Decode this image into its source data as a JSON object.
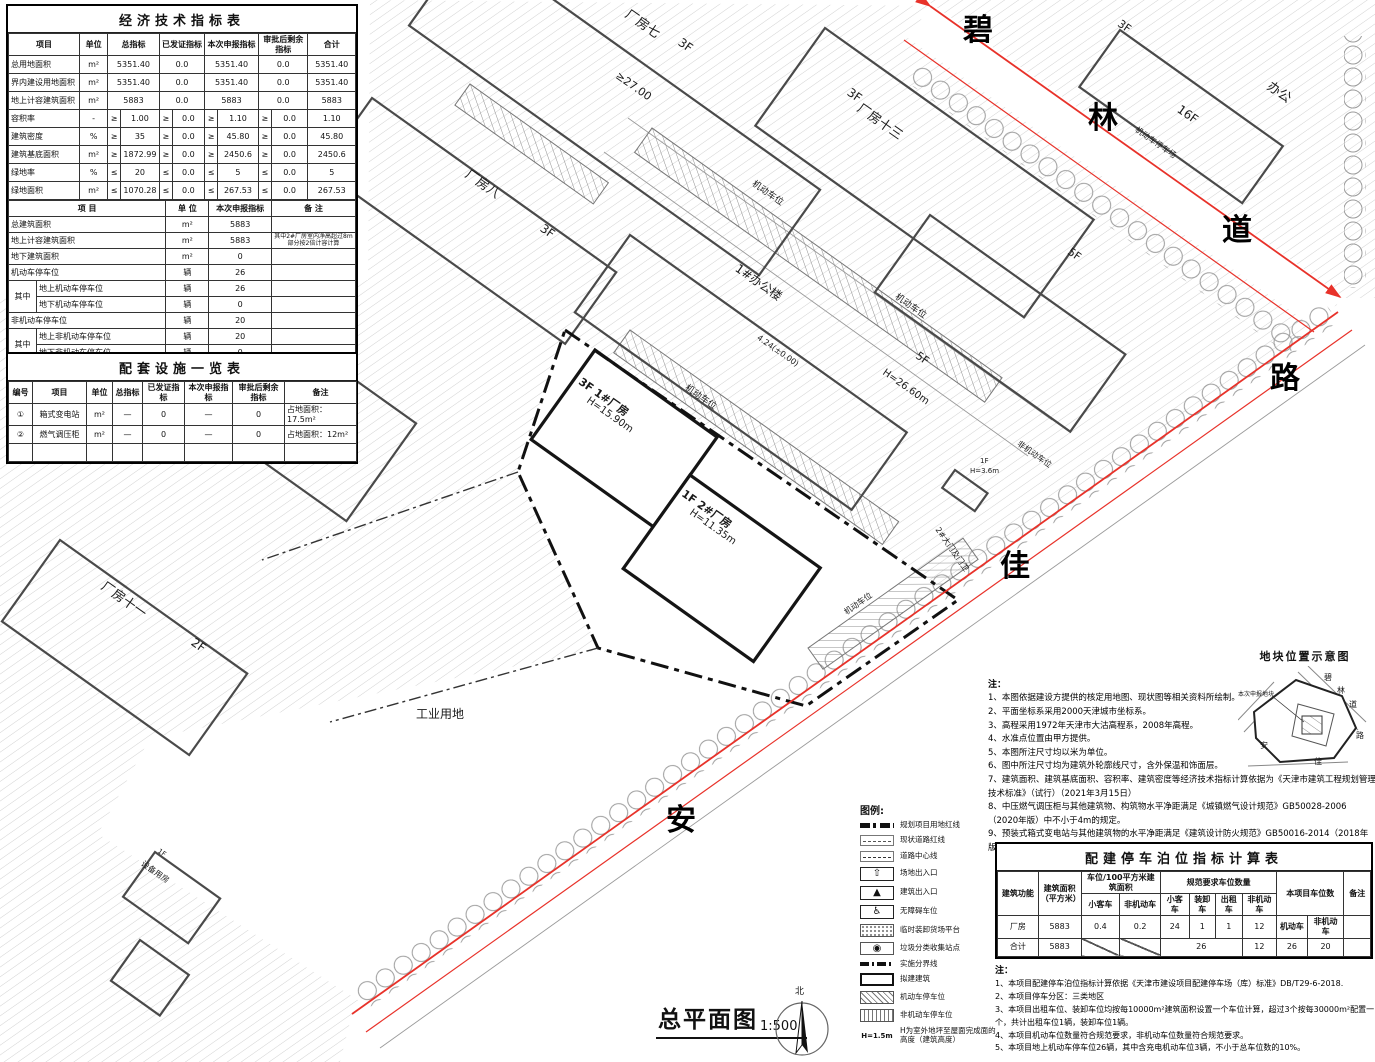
{
  "sheet": {
    "title": "总平面图",
    "scale": "1:500",
    "north_label": "北"
  },
  "econ_table": {
    "title": "经济技术指标表",
    "rows": [
      [
        {
          "t": "项目",
          "h": 1
        },
        {
          "t": "单位",
          "h": 1
        },
        {
          "t": "总指标",
          "c": 2,
          "h": 1
        },
        {
          "t": "已发证指标",
          "c": 2,
          "h": 1
        },
        {
          "t": "本次申报指标",
          "c": 2,
          "h": 1
        },
        {
          "t": "审批后剩余指标",
          "c": 2,
          "h": 1
        },
        {
          "t": "合计",
          "h": 1
        }
      ],
      [
        {
          "t": "总用地面积",
          "cls": "l"
        },
        "m²",
        {
          "t": "5351.40",
          "c": 2
        },
        {
          "t": "0.0",
          "c": 2
        },
        {
          "t": "5351.40",
          "c": 2
        },
        {
          "t": "0.0",
          "c": 2
        },
        "5351.40"
      ],
      [
        {
          "t": "界内建设用地面积",
          "cls": "l"
        },
        "m²",
        {
          "t": "5351.40",
          "c": 2
        },
        {
          "t": "0.0",
          "c": 2
        },
        {
          "t": "5351.40",
          "c": 2
        },
        {
          "t": "0.0",
          "c": 2
        },
        "5351.40"
      ],
      [
        {
          "t": "地上计容建筑面积",
          "cls": "l"
        },
        "m²",
        {
          "t": "5883",
          "c": 2
        },
        {
          "t": "0.0",
          "c": 2
        },
        {
          "t": "5883",
          "c": 2
        },
        {
          "t": "0.0",
          "c": 2
        },
        "5883"
      ],
      [
        {
          "t": "容积率",
          "cls": "l"
        },
        "-",
        "≥",
        "1.00",
        "≥",
        "0.0",
        "≥",
        "1.10",
        "≥",
        "0.0",
        "1.10"
      ],
      [
        {
          "t": "建筑密度",
          "cls": "l"
        },
        "%",
        "≥",
        "35",
        "≥",
        "0.0",
        "≥",
        "45.80",
        "≥",
        "0.0",
        "45.80"
      ],
      [
        {
          "t": "建筑基底面积",
          "cls": "l"
        },
        "m²",
        "≥",
        "1872.99",
        "≥",
        "0.0",
        "≥",
        "2450.6",
        "≥",
        "0.0",
        "2450.6"
      ],
      [
        {
          "t": "绿地率",
          "cls": "l"
        },
        "%",
        "≤",
        "20",
        "≤",
        "0.0",
        "≤",
        "5",
        "≤",
        "0.0",
        "5"
      ],
      [
        {
          "t": "绿地面积",
          "cls": "l"
        },
        "m²",
        "≤",
        "1070.28",
        "≤",
        "0.0",
        "≤",
        "267.53",
        "≤",
        "0.0",
        "267.53"
      ]
    ]
  },
  "econ_table2": {
    "rows": [
      [
        {
          "t": "项    目",
          "c": 2,
          "h": 1
        },
        {
          "t": "单 位",
          "h": 1
        },
        {
          "t": "本次申报指标",
          "h": 1
        },
        {
          "t": "备 注",
          "h": 1
        }
      ],
      [
        {
          "t": "总建筑面积",
          "c": 2,
          "cls": "l"
        },
        "m²",
        "5883",
        ""
      ],
      [
        {
          "t": "地上计容建筑面积",
          "c": 2,
          "cls": "l"
        },
        "m²",
        "5883",
        {
          "t": "其中2#厂房室内净高超过8m部分按2倍计容计算",
          "cls": "tiny"
        }
      ],
      [
        {
          "t": "地下建筑面积",
          "c": 2,
          "cls": "l"
        },
        "m²",
        "0",
        ""
      ],
      [
        {
          "t": "机动车停车位",
          "c": 2,
          "cls": "l"
        },
        "辆",
        "26",
        ""
      ],
      [
        {
          "t": "其中",
          "r": 2
        },
        {
          "t": "地上机动车停车位",
          "cls": "l"
        },
        "辆",
        "26",
        ""
      ],
      [
        {
          "t": "地下机动车停车位",
          "cls": "l"
        },
        "辆",
        "0",
        ""
      ],
      [
        {
          "t": "非机动车停车位",
          "c": 2,
          "cls": "l"
        },
        "辆",
        "20",
        ""
      ],
      [
        {
          "t": "其中",
          "r": 2
        },
        {
          "t": "地上非机动车停车位",
          "cls": "l"
        },
        "辆",
        "20",
        ""
      ],
      [
        {
          "t": "地下非机动车停车位",
          "cls": "l"
        },
        "辆",
        "0",
        ""
      ]
    ]
  },
  "facilities_table": {
    "title": "配套设施一览表",
    "rows": [
      [
        {
          "t": "编号",
          "h": 1
        },
        {
          "t": "项目",
          "h": 1
        },
        {
          "t": "单位",
          "h": 1
        },
        {
          "t": "总指标",
          "h": 1
        },
        {
          "t": "已发证指标",
          "h": 1
        },
        {
          "t": "本次申报指标",
          "h": 1
        },
        {
          "t": "审批后剩余指标",
          "h": 1
        },
        {
          "t": "备注",
          "h": 1
        }
      ],
      [
        "①",
        "箱式变电站",
        "m²",
        "—",
        "0",
        "—",
        "0",
        {
          "t": "占地面积：17.5m²",
          "cls": "l"
        }
      ],
      [
        "②",
        "燃气调压柜",
        "m²",
        "—",
        "0",
        "—",
        "0",
        {
          "t": "占地面积：12m²",
          "cls": "l"
        }
      ],
      [
        " ",
        "",
        "",
        "",
        "",
        "",
        "",
        ""
      ]
    ]
  },
  "parking_table": {
    "title": "配建停车泊位指标计算表",
    "rows": [
      [
        {
          "t": "建筑功能",
          "r": 2,
          "h": 1
        },
        {
          "t": "建筑面积（平方米）",
          "r": 2,
          "h": 1
        },
        {
          "t": "车位/100平方米建筑面积",
          "c": 2,
          "h": 1
        },
        {
          "t": "规范要求车位数量",
          "c": 4,
          "h": 1
        },
        {
          "t": "本项目车位数",
          "c": 2,
          "r": 2,
          "h": 1
        },
        {
          "t": "备注",
          "r": 2,
          "h": 1
        }
      ],
      [
        {
          "t": "小客车",
          "h": 1
        },
        {
          "t": "非机动车",
          "h": 1
        },
        {
          "t": "小客车",
          "h": 1
        },
        {
          "t": "装卸车",
          "h": 1
        },
        {
          "t": "出租车",
          "h": 1
        },
        {
          "t": "非机动车",
          "h": 1
        }
      ],
      [
        "厂房",
        "5883",
        "0.4",
        "0.2",
        "24",
        "1",
        "1",
        "12",
        {
          "t": "机动车",
          "h": 1
        },
        {
          "t": "非机动车",
          "h": 1
        },
        ""
      ],
      [
        "合计",
        "5883",
        {
          "t": "",
          "cls": "diag"
        },
        {
          "t": "",
          "cls": "diag"
        },
        {
          "t": "26",
          "c": 3
        },
        "12",
        "26",
        "20",
        ""
      ]
    ]
  },
  "notes": {
    "label": "注：",
    "items": [
      "1、本图依据建设方提供的核定用地图、现状图等相关资料所绘制。",
      "2、平面坐标系采用2000天津城市坐标系。",
      "3、高程采用1972年天津市大沽高程系，2008年高程。",
      "4、水准点位置由甲方提供。",
      "5、本图所注尺寸均以米为单位。",
      "6、图中所注尺寸均为建筑外轮廓线尺寸，含外保温和饰面层。",
      "7、建筑面积、建筑基底面积、容积率、建筑密度等经济技术指标计算依据为《天津市建筑工程规划管理技术标准》（试行）（2021年3月15日）",
      "8、中压燃气调压柜与其他建筑物、构筑物水平净距满足《城镇燃气设计规范》GB50028-2006（2020年版）中不小于4m的规定。",
      "9、预装式箱式变电站与其他建筑物的水平净距满足《建筑设计防火规范》GB50016-2014（2018年版）中不小于3m的规定。"
    ]
  },
  "parking_notes": {
    "label": "注：",
    "items": [
      "1、本项目配建停车泊位指标计算依据《天津市建设项目配建停车场（库）标准》DB/T29-6-2018.",
      "2、本项目停车分区：三类地区",
      "3、本项目出租车位、装卸车位均按每10000m²建筑面积设置一个车位计算，超过3个按每30000m²配置一个，共计出租车位1辆，装卸车位1辆。",
      "4、本项目机动车位数量符合规范要求，非机动车位数量符合规范要求。",
      "5、本项目地上机动车停车位26辆，其中含充电机动车位3辆，不小于总车位数的10%。"
    ]
  },
  "legend": {
    "label": "图例:",
    "items": [
      {
        "sym": "redbound",
        "label": "规划项目用地红线"
      },
      {
        "sym": "roadred",
        "label": "现状道路红线"
      },
      {
        "sym": "centerline",
        "label": "道路中心线"
      },
      {
        "sym": "entry",
        "glyph": "⇧",
        "label": "场地出入口"
      },
      {
        "sym": "entry",
        "glyph": "▲",
        "label": "建筑出入口"
      },
      {
        "sym": "entry",
        "glyph": "♿",
        "label": "无障碍车位"
      },
      {
        "sym": "dock",
        "label": "临时装卸货场平台"
      },
      {
        "sym": "waste",
        "glyph": "◉",
        "label": "垃圾分类收集站点"
      },
      {
        "sym": "phase",
        "label": "实施分界线"
      },
      {
        "sym": "proposed",
        "label": "拟建建筑"
      },
      {
        "sym": "carpark",
        "label": "机动车停车位"
      },
      {
        "sym": "bikepark",
        "label": "非机动车停车位"
      },
      {
        "sym": "htext",
        "glyph": "H=1.5m",
        "label": "H为室外地坪至屋面完成面的高度（建筑高度）"
      }
    ]
  },
  "inset": {
    "title": "地块位置示意图",
    "labels": [
      {
        "t": "本次申报地块",
        "x": 0,
        "y": 26,
        "s": 6
      },
      {
        "t": "碧",
        "x": 86,
        "y": 8,
        "s": 8
      },
      {
        "t": "林",
        "x": 99,
        "y": 21,
        "s": 8
      },
      {
        "t": "道",
        "x": 111,
        "y": 35,
        "s": 8
      },
      {
        "t": "路",
        "x": 118,
        "y": 66,
        "s": 8
      },
      {
        "t": "佳",
        "x": 76,
        "y": 92,
        "s": 8
      },
      {
        "t": "安",
        "x": 22,
        "y": 76,
        "s": 8
      }
    ]
  },
  "map": {
    "labels": [
      {
        "t": "碧",
        "x": 963,
        "y": 16,
        "s": 30,
        "cls": "roadchar",
        "n": "road-name-bilin-1"
      },
      {
        "t": "林",
        "x": 1088,
        "y": 104,
        "s": 30,
        "cls": "roadchar",
        "n": "road-name-bilin-2"
      },
      {
        "t": "道",
        "x": 1222,
        "y": 216,
        "s": 30,
        "cls": "roadchar",
        "n": "road-name-bilin-3"
      },
      {
        "t": "路",
        "x": 1270,
        "y": 364,
        "s": 30,
        "cls": "roadchar",
        "n": "road-name-anjia-3"
      },
      {
        "t": "佳",
        "x": 1000,
        "y": 552,
        "s": 30,
        "cls": "roadchar",
        "n": "road-name-anjia-2"
      },
      {
        "t": "安",
        "x": 666,
        "y": 806,
        "s": 30,
        "cls": "roadchar",
        "n": "road-name-anjia-1"
      },
      {
        "t": "厂房七",
        "x": 630,
        "y": 8,
        "r": 35,
        "s": 13
      },
      {
        "t": "3F",
        "x": 683,
        "y": 36,
        "r": 35,
        "s": 12
      },
      {
        "t": "厂房八",
        "x": 470,
        "y": 168,
        "r": 35,
        "s": 13
      },
      {
        "t": "3F",
        "x": 545,
        "y": 222,
        "r": 35,
        "s": 12
      },
      {
        "t": "厂房九",
        "x": 268,
        "y": 320,
        "r": 35,
        "s": 13
      },
      {
        "t": "3F",
        "x": 336,
        "y": 368,
        "r": 35,
        "s": 12
      },
      {
        "t": "3F",
        "x": 852,
        "y": 86,
        "r": 35,
        "s": 12
      },
      {
        "t": "厂房十三",
        "x": 862,
        "y": 102,
        "r": 35,
        "s": 13
      },
      {
        "t": "1#办公楼",
        "x": 740,
        "y": 262,
        "r": 35,
        "s": 12
      },
      {
        "t": "5F",
        "x": 920,
        "y": 350,
        "r": 35,
        "s": 11
      },
      {
        "t": "H=26.60m",
        "x": 886,
        "y": 368,
        "r": 35,
        "s": 10
      },
      {
        "t": "5F",
        "x": 1072,
        "y": 246,
        "r": 35,
        "s": 11
      },
      {
        "t": "16F",
        "x": 1182,
        "y": 103,
        "r": 35,
        "s": 12
      },
      {
        "t": "办公",
        "x": 1272,
        "y": 80,
        "r": 35,
        "s": 13
      },
      {
        "t": "3F",
        "x": 1122,
        "y": 18,
        "r": 35,
        "s": 11
      },
      {
        "t": "机动车停车场",
        "x": 1138,
        "y": 126,
        "r": 35,
        "s": 8
      },
      {
        "t": "机动车位",
        "x": 755,
        "y": 180,
        "r": 35,
        "s": 9
      },
      {
        "t": "机动车位",
        "x": 688,
        "y": 384,
        "r": 35,
        "s": 9
      },
      {
        "t": "机动车位",
        "x": 898,
        "y": 293,
        "r": 35,
        "s": 9
      },
      {
        "t": "机动车位",
        "x": 843,
        "y": 610,
        "r": -35,
        "s": 8
      },
      {
        "t": "非机动车位",
        "x": 1020,
        "y": 440,
        "r": 35,
        "s": 8
      },
      {
        "t": "≥27.00",
        "x": 620,
        "y": 70,
        "r": 35,
        "s": 11
      },
      {
        "t": "4.24(±0.00)",
        "x": 760,
        "y": 334,
        "r": 35,
        "s": 8
      },
      {
        "t": "3F 1#厂房",
        "x": 583,
        "y": 376,
        "r": 35,
        "s": 11,
        "b": 1,
        "n": "label-factory-1"
      },
      {
        "t": "H=15.90m",
        "x": 590,
        "y": 396,
        "r": 35,
        "s": 10,
        "n": "label-factory-1-height"
      },
      {
        "t": "1F 2#厂房",
        "x": 686,
        "y": 488,
        "r": 35,
        "s": 11,
        "b": 1,
        "n": "label-factory-2"
      },
      {
        "t": "H=11.35m",
        "x": 693,
        "y": 508,
        "r": 35,
        "s": 10,
        "n": "label-factory-2-height"
      },
      {
        "t": "工业用地",
        "x": 416,
        "y": 708,
        "s": 12,
        "n": "label-industrial-land"
      },
      {
        "t": "2#大门及门卫",
        "x": 940,
        "y": 526,
        "r": 55,
        "s": 8,
        "n": "label-gate-2"
      },
      {
        "t": "1F",
        "x": 980,
        "y": 458,
        "s": 7
      },
      {
        "t": "H=3.6m",
        "x": 970,
        "y": 468,
        "s": 7
      },
      {
        "t": "厂房十一",
        "x": 106,
        "y": 580,
        "r": 35,
        "s": 13
      },
      {
        "t": "2F",
        "x": 196,
        "y": 636,
        "r": 35,
        "s": 12
      },
      {
        "t": "1F",
        "x": 160,
        "y": 848,
        "r": 35,
        "s": 7
      },
      {
        "t": "设备用房",
        "x": 144,
        "y": 860,
        "r": 35,
        "s": 8
      }
    ]
  }
}
